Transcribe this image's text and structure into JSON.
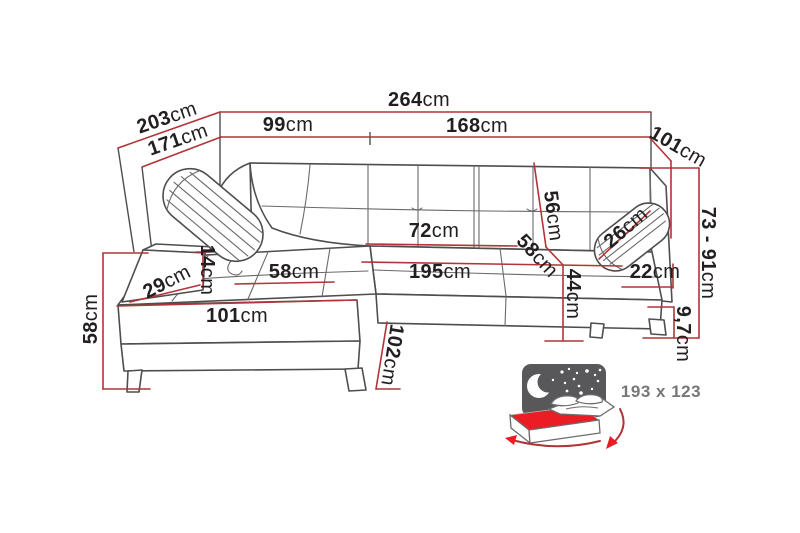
{
  "diagram": {
    "type": "furniture-dimension-drawing",
    "subject": "corner-sofa-with-left-chaise",
    "colors": {
      "dimension_line": "#b13438",
      "outline_gray": "#4e4e50",
      "label_text": "#231f20",
      "sleep_icon_gray": "#58585a",
      "mattress_red": "#ec1c24",
      "sleep_label_gray": "#77777a",
      "background": "#ffffff"
    }
  },
  "labels": {
    "w264": {
      "value": "264",
      "unit": "cm"
    },
    "d203": {
      "value": "203",
      "unit": "cm"
    },
    "d171": {
      "value": "171",
      "unit": "cm"
    },
    "w99": {
      "value": "99",
      "unit": "cm"
    },
    "w168": {
      "value": "168",
      "unit": "cm"
    },
    "d101": {
      "value": "101",
      "unit": "cm"
    },
    "h73_91": {
      "value": "73 - 91",
      "unit": "cm"
    },
    "p26": {
      "value": "26",
      "unit": "cm"
    },
    "a22": {
      "value": "22",
      "unit": "cm"
    },
    "l9_7": {
      "value": "9,7",
      "unit": "cm"
    },
    "b56": {
      "value": "56",
      "unit": "cm"
    },
    "s58": {
      "value": "58",
      "unit": "cm"
    },
    "h44": {
      "value": "44",
      "unit": "cm"
    },
    "t72": {
      "value": "72",
      "unit": "cm"
    },
    "w195": {
      "value": "195",
      "unit": "cm"
    },
    "c58": {
      "value": "58",
      "unit": "cm"
    },
    "p14": {
      "value": "14",
      "unit": "cm"
    },
    "a29": {
      "value": "29",
      "unit": "cm"
    },
    "f101": {
      "value": "101",
      "unit": "cm"
    },
    "h58": {
      "value": "58",
      "unit": "cm"
    },
    "l102": {
      "value": "102",
      "unit": "cm"
    }
  },
  "sleeping_area": {
    "label": "193 x 123"
  }
}
